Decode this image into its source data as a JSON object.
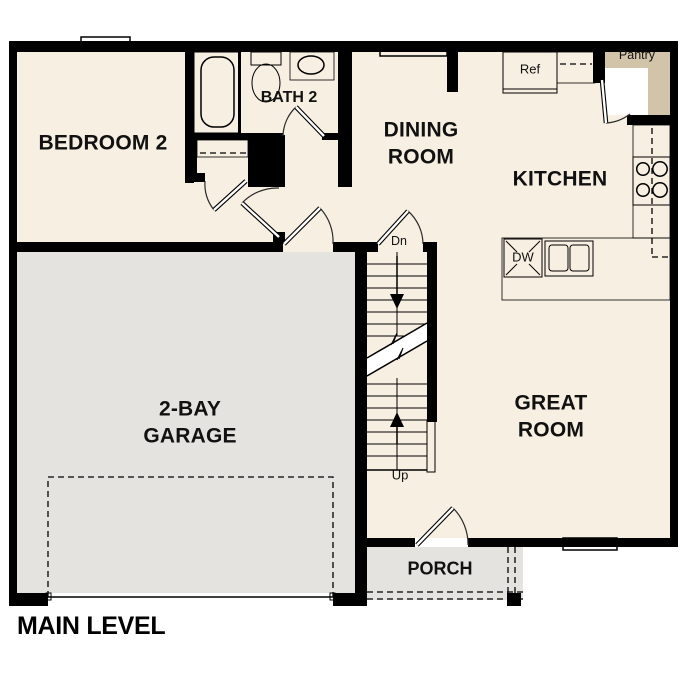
{
  "title": "MAIN LEVEL",
  "rooms": {
    "bedroom2": "BEDROOM 2",
    "bath2": "BATH 2",
    "dining_line1": "DINING",
    "dining_line2": "ROOM",
    "kitchen": "KITCHEN",
    "great_line1": "GREAT",
    "great_line2": "ROOM",
    "garage_line1": "2-BAY",
    "garage_line2": "GARAGE",
    "porch": "PORCH",
    "pantry": "Pantry"
  },
  "fixtures": {
    "refrigerator": "Ref",
    "dishwasher": "DW"
  },
  "stairs": {
    "down": "Dn",
    "up": "Up"
  },
  "colors": {
    "wall": "#000000",
    "floor": "#f7efe2",
    "concrete": "#e4e3e0",
    "cabinet": "#d2c4a8",
    "water": "#aac9e8",
    "appliance": "#e9e9e9"
  }
}
